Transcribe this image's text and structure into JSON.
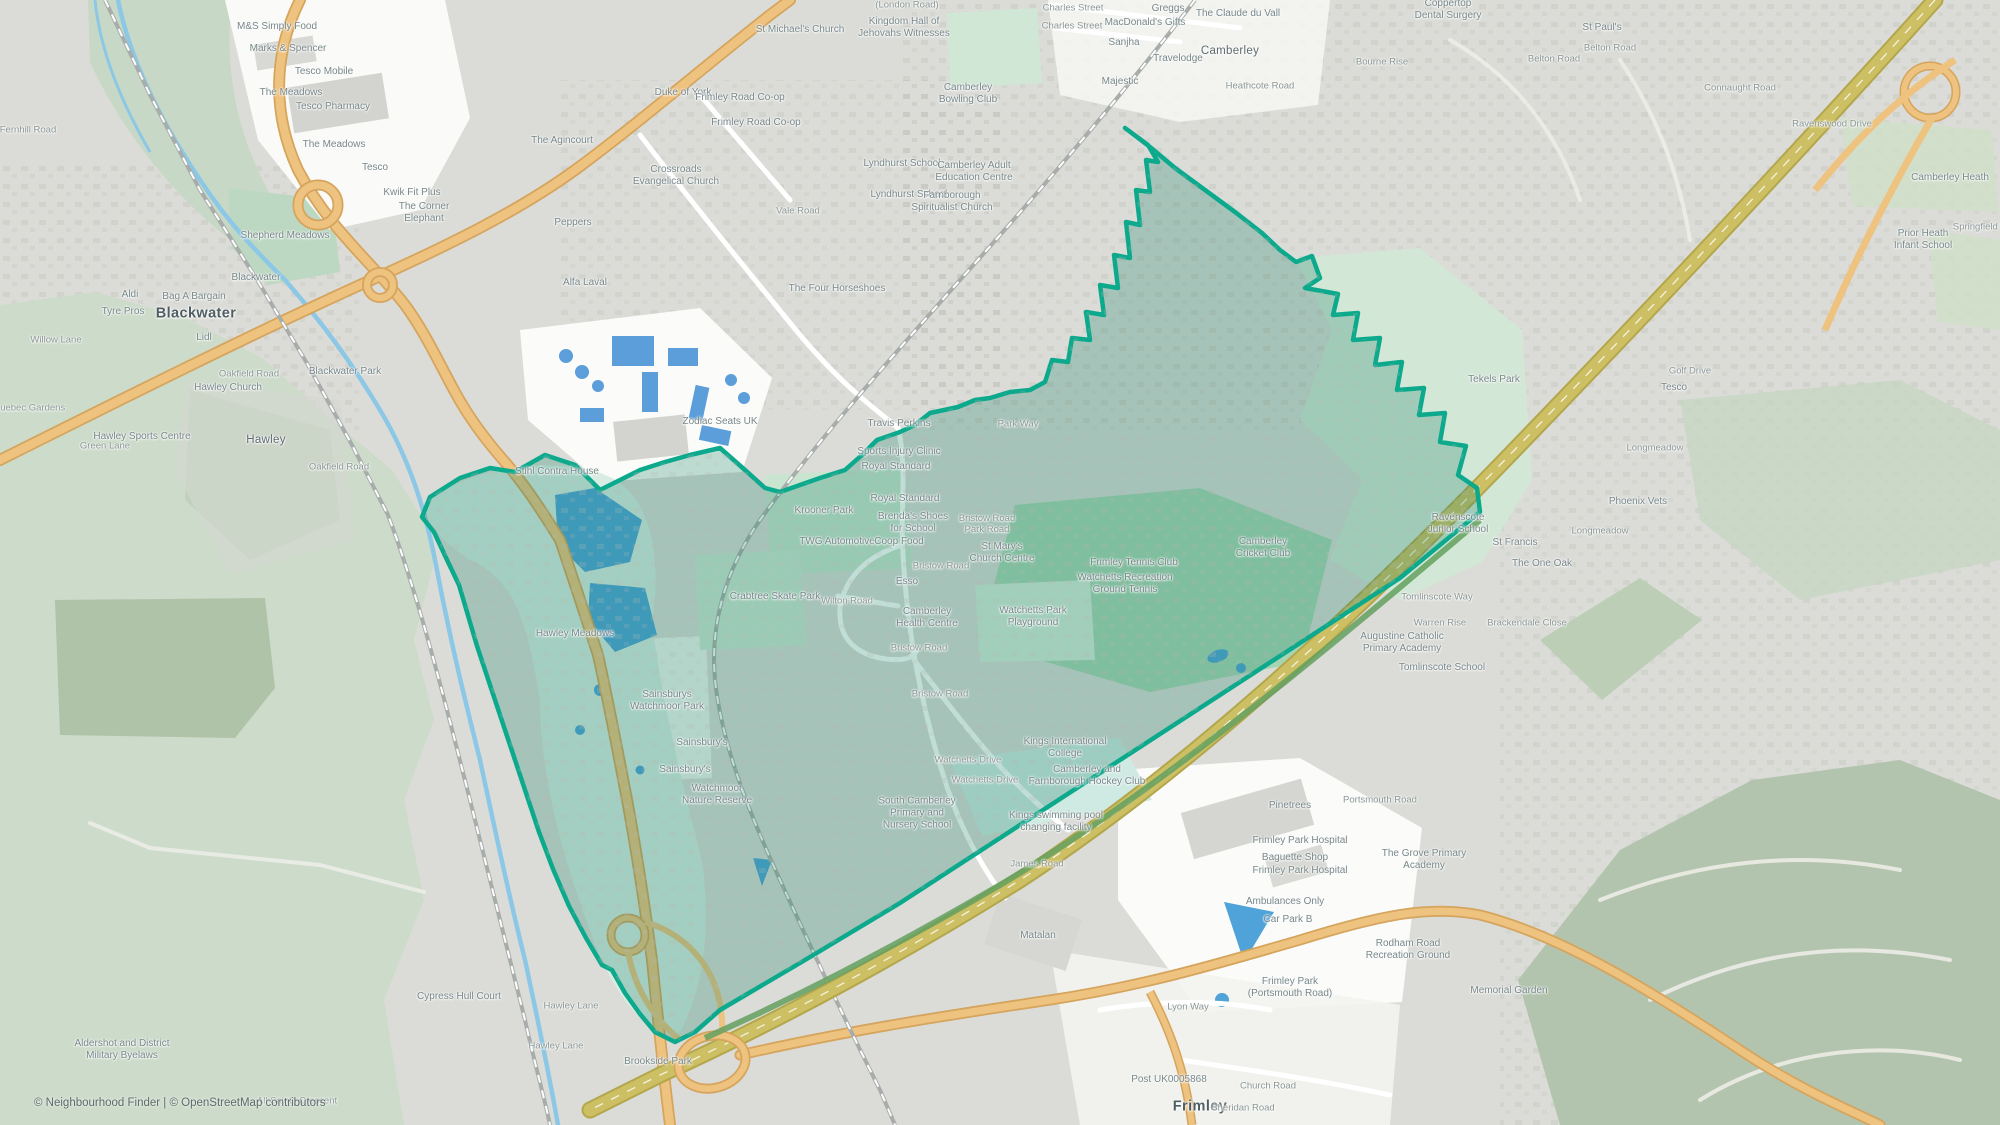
{
  "attribution": {
    "text": "© Neighbourhood Finder | © OpenStreetMap contributors"
  },
  "colors": {
    "urban": "#dbdcd7",
    "woodland": "#ccdbca",
    "park_mint": "#cde6d3",
    "recreation_green": "#a6d5b3",
    "retail_white": "#fafbf8",
    "water": "#4fa3d8",
    "river": "#8cc8e6",
    "road_primary_fill": "#eec27f",
    "road_primary_casing": "#d5a45d",
    "motorway_fill": "#cdbf63",
    "motorway_casing": "#b3a64b",
    "railway": "#a8adab",
    "building_blue": "#5b9ed9",
    "boundary_stroke": "#0ca98c",
    "boundary_fill": "rgba(23,128,104,0.27)",
    "boundary_green_strip": "#63a05f"
  },
  "labels": [
    {
      "lines": [
        "Blackwater"
      ],
      "x": 196,
      "y": 314,
      "k": "city"
    },
    {
      "lines": [
        "Frimley"
      ],
      "x": 1200,
      "y": 1107,
      "k": "city"
    },
    {
      "lines": [
        "Hawley"
      ],
      "x": 266,
      "y": 441,
      "k": "town"
    },
    {
      "lines": [
        "Camberley"
      ],
      "x": 1230,
      "y": 52,
      "k": "town"
    },
    {
      "lines": [
        "M&S Simply Food"
      ],
      "x": 277,
      "y": 27,
      "k": "poi"
    },
    {
      "lines": [
        "Marks & Spencer"
      ],
      "x": 288,
      "y": 49,
      "k": "poi"
    },
    {
      "lines": [
        "Tesco Mobile"
      ],
      "x": 324,
      "y": 72,
      "k": "poi"
    },
    {
      "lines": [
        "The Meadows"
      ],
      "x": 291,
      "y": 93,
      "k": "poi"
    },
    {
      "lines": [
        "Tesco Pharmacy"
      ],
      "x": 333,
      "y": 107,
      "k": "poi"
    },
    {
      "lines": [
        "The Meadows"
      ],
      "x": 334,
      "y": 145,
      "k": "poi"
    },
    {
      "lines": [
        "Tesco"
      ],
      "x": 375,
      "y": 168,
      "k": "poi"
    },
    {
      "lines": [
        "Kwik Fit Plus"
      ],
      "x": 412,
      "y": 193,
      "k": "poi"
    },
    {
      "lines": [
        "The Corner",
        "Elephant"
      ],
      "x": 424,
      "y": 213,
      "k": "poi"
    },
    {
      "lines": [
        "Shepherd Meadows"
      ],
      "x": 285,
      "y": 236,
      "k": "poi"
    },
    {
      "lines": [
        "Blackwater"
      ],
      "x": 256,
      "y": 278,
      "k": "poi"
    },
    {
      "lines": [
        "Aldi"
      ],
      "x": 130,
      "y": 295,
      "k": "poi"
    },
    {
      "lines": [
        "Bag A Bargain"
      ],
      "x": 194,
      "y": 297,
      "k": "poi"
    },
    {
      "lines": [
        "Tyre Pros"
      ],
      "x": 123,
      "y": 312,
      "k": "poi"
    },
    {
      "lines": [
        "Willow Lane"
      ],
      "x": 56,
      "y": 340,
      "k": "road"
    },
    {
      "lines": [
        "Lidl"
      ],
      "x": 204,
      "y": 338,
      "k": "poi"
    },
    {
      "lines": [
        "Oakfield Road"
      ],
      "x": 249,
      "y": 374,
      "k": "road"
    },
    {
      "lines": [
        "Blackwater Park"
      ],
      "x": 345,
      "y": 372,
      "k": "poi"
    },
    {
      "lines": [
        "Quebec Gardens"
      ],
      "x": 29,
      "y": 408,
      "k": "road"
    },
    {
      "lines": [
        "Green Lane"
      ],
      "x": 105,
      "y": 446,
      "k": "road"
    },
    {
      "lines": [
        "Fernhill Road"
      ],
      "x": 28,
      "y": 130,
      "k": "road"
    },
    {
      "lines": [
        "Hawley Church"
      ],
      "x": 228,
      "y": 388,
      "k": "poi"
    },
    {
      "lines": [
        "Hawley Sports Centre"
      ],
      "x": 142,
      "y": 437,
      "k": "poi"
    },
    {
      "lines": [
        "Oakfield Road"
      ],
      "x": 339,
      "y": 467,
      "k": "road"
    },
    {
      "lines": [
        "Hawley Meadows"
      ],
      "x": 575,
      "y": 634,
      "k": "poi"
    },
    {
      "lines": [
        "Stihl Contra House"
      ],
      "x": 557,
      "y": 472,
      "k": "poi"
    },
    {
      "lines": [
        "St Michael's Church"
      ],
      "x": 800,
      "y": 30,
      "k": "poi"
    },
    {
      "lines": [
        "(London Road)"
      ],
      "x": 907,
      "y": 5,
      "k": "road"
    },
    {
      "lines": [
        "Kingdom Hall of",
        "Jehovahs Witnesses"
      ],
      "x": 904,
      "y": 28,
      "k": "poi"
    },
    {
      "lines": [
        "Camberley",
        "Bowling Club"
      ],
      "x": 968,
      "y": 94,
      "k": "poi"
    },
    {
      "lines": [
        "Charles Street"
      ],
      "x": 1073,
      "y": 8,
      "k": "road"
    },
    {
      "lines": [
        "Charles Street"
      ],
      "x": 1072,
      "y": 26,
      "k": "road"
    },
    {
      "lines": [
        "Greggs"
      ],
      "x": 1168,
      "y": 9,
      "k": "poi"
    },
    {
      "lines": [
        "MacDonald's Gifts"
      ],
      "x": 1145,
      "y": 23,
      "k": "poi"
    },
    {
      "lines": [
        "The Claude du Vall"
      ],
      "x": 1238,
      "y": 14,
      "k": "poi"
    },
    {
      "lines": [
        "Sanjha"
      ],
      "x": 1124,
      "y": 43,
      "k": "poi"
    },
    {
      "lines": [
        "Travelodge"
      ],
      "x": 1178,
      "y": 59,
      "k": "poi"
    },
    {
      "lines": [
        "Majestic"
      ],
      "x": 1120,
      "y": 82,
      "k": "poi"
    },
    {
      "lines": [
        "Heathcote Road"
      ],
      "x": 1260,
      "y": 86,
      "k": "road"
    },
    {
      "lines": [
        "Duke of York"
      ],
      "x": 683,
      "y": 93,
      "k": "poi"
    },
    {
      "lines": [
        "Frimley Road Co-op"
      ],
      "x": 740,
      "y": 98,
      "k": "poi"
    },
    {
      "lines": [
        "Frimley Road Co-op"
      ],
      "x": 756,
      "y": 123,
      "k": "poi"
    },
    {
      "lines": [
        "The Agincourt"
      ],
      "x": 562,
      "y": 141,
      "k": "poi"
    },
    {
      "lines": [
        "Crossroads",
        "Evangelical Church"
      ],
      "x": 676,
      "y": 176,
      "k": "poi"
    },
    {
      "lines": [
        "Vale Road"
      ],
      "x": 798,
      "y": 211,
      "k": "road"
    },
    {
      "lines": [
        "Peppers"
      ],
      "x": 573,
      "y": 223,
      "k": "poi"
    },
    {
      "lines": [
        "Alfa Laval"
      ],
      "x": 585,
      "y": 283,
      "k": "poi"
    },
    {
      "lines": [
        "The Four Horseshoes"
      ],
      "x": 837,
      "y": 289,
      "k": "poi"
    },
    {
      "lines": [
        "Lyndhurst School"
      ],
      "x": 902,
      "y": 164,
      "k": "poi"
    },
    {
      "lines": [
        "Lyndhurst School"
      ],
      "x": 909,
      "y": 195,
      "k": "poi"
    },
    {
      "lines": [
        "Camberley Adult",
        "Education Centre"
      ],
      "x": 974,
      "y": 172,
      "k": "poi"
    },
    {
      "lines": [
        "Farnborough",
        "Spiritualist Church"
      ],
      "x": 952,
      "y": 202,
      "k": "poi"
    },
    {
      "lines": [
        "Coppertop",
        "Dental Surgery"
      ],
      "x": 1448,
      "y": 10,
      "k": "poi"
    },
    {
      "lines": [
        "St Paul's"
      ],
      "x": 1602,
      "y": 28,
      "k": "poi"
    },
    {
      "lines": [
        "Belton Road"
      ],
      "x": 1610,
      "y": 48,
      "k": "road"
    },
    {
      "lines": [
        "Belton Road"
      ],
      "x": 1554,
      "y": 59,
      "k": "road"
    },
    {
      "lines": [
        "Bourne Rise"
      ],
      "x": 1382,
      "y": 62,
      "k": "road"
    },
    {
      "lines": [
        "Connaught Road"
      ],
      "x": 1740,
      "y": 88,
      "k": "road"
    },
    {
      "lines": [
        "Ravenswood Drive"
      ],
      "x": 1832,
      "y": 124,
      "k": "road"
    },
    {
      "lines": [
        "Camberley Heath"
      ],
      "x": 1950,
      "y": 178,
      "k": "poi"
    },
    {
      "lines": [
        "Prior Heath",
        "Infant School"
      ],
      "x": 1923,
      "y": 240,
      "k": "poi"
    },
    {
      "lines": [
        "Springfield Road"
      ],
      "x": 1988,
      "y": 227,
      "k": "road"
    },
    {
      "lines": [
        "Golf Drive"
      ],
      "x": 1690,
      "y": 371,
      "k": "road"
    },
    {
      "lines": [
        "Tesco"
      ],
      "x": 1674,
      "y": 388,
      "k": "poi"
    },
    {
      "lines": [
        "Tekels Park"
      ],
      "x": 1494,
      "y": 380,
      "k": "poi"
    },
    {
      "lines": [
        "Longmeadow"
      ],
      "x": 1655,
      "y": 448,
      "k": "road"
    },
    {
      "lines": [
        "Longmeadow"
      ],
      "x": 1600,
      "y": 531,
      "k": "road"
    },
    {
      "lines": [
        "Phoenix Vets"
      ],
      "x": 1638,
      "y": 502,
      "k": "poi"
    },
    {
      "lines": [
        "The One Oak"
      ],
      "x": 1542,
      "y": 564,
      "k": "poi"
    },
    {
      "lines": [
        "Brackendale Close"
      ],
      "x": 1527,
      "y": 623,
      "k": "road"
    },
    {
      "lines": [
        "Ravenscote",
        "Junior School"
      ],
      "x": 1458,
      "y": 524,
      "k": "poi"
    },
    {
      "lines": [
        "St Francis"
      ],
      "x": 1515,
      "y": 543,
      "k": "poi"
    },
    {
      "lines": [
        "Tomlinscote Way"
      ],
      "x": 1437,
      "y": 597,
      "k": "road"
    },
    {
      "lines": [
        "Warren Rise"
      ],
      "x": 1440,
      "y": 623,
      "k": "road"
    },
    {
      "lines": [
        "Augustine Catholic",
        "Primary Academy"
      ],
      "x": 1402,
      "y": 643,
      "k": "poi"
    },
    {
      "lines": [
        "Tomlinscote School"
      ],
      "x": 1442,
      "y": 668,
      "k": "poi"
    },
    {
      "lines": [
        "Park Way"
      ],
      "x": 1018,
      "y": 424,
      "k": "road"
    },
    {
      "lines": [
        "Zodiac Seats UK"
      ],
      "x": 720,
      "y": 422,
      "k": "poi"
    },
    {
      "lines": [
        "Travis Perkins"
      ],
      "x": 899,
      "y": 424,
      "k": "poi"
    },
    {
      "lines": [
        "Sports Injury Clinic"
      ],
      "x": 899,
      "y": 452,
      "k": "poi"
    },
    {
      "lines": [
        "Royal Standard"
      ],
      "x": 896,
      "y": 467,
      "k": "poi"
    },
    {
      "lines": [
        "Royal Standard"
      ],
      "x": 905,
      "y": 499,
      "k": "poi"
    },
    {
      "lines": [
        "Krooner Park"
      ],
      "x": 824,
      "y": 511,
      "k": "poi"
    },
    {
      "lines": [
        "Brenda's Shoes",
        "for School"
      ],
      "x": 913,
      "y": 523,
      "k": "poi"
    },
    {
      "lines": [
        "TWG Automotive"
      ],
      "x": 837,
      "y": 542,
      "k": "poi"
    },
    {
      "lines": [
        "Coop Food"
      ],
      "x": 899,
      "y": 542,
      "k": "poi"
    },
    {
      "lines": [
        "Bristow Road"
      ],
      "x": 941,
      "y": 566,
      "k": "road"
    },
    {
      "lines": [
        "Esso"
      ],
      "x": 907,
      "y": 582,
      "k": "poi"
    },
    {
      "lines": [
        "Crabtree Skate Park"
      ],
      "x": 775,
      "y": 597,
      "k": "poi"
    },
    {
      "lines": [
        "Wilton Road"
      ],
      "x": 847,
      "y": 601,
      "k": "road"
    },
    {
      "lines": [
        "Bristow Road",
        "Park Road"
      ],
      "x": 987,
      "y": 524,
      "k": "road"
    },
    {
      "lines": [
        "St Mary's",
        "Church Centre"
      ],
      "x": 1002,
      "y": 553,
      "k": "poi"
    },
    {
      "lines": [
        "Camberley",
        "Health Centre"
      ],
      "x": 927,
      "y": 618,
      "k": "poi"
    },
    {
      "lines": [
        "Bristow Road"
      ],
      "x": 919,
      "y": 648,
      "k": "road"
    },
    {
      "lines": [
        "Watchetts Park",
        "Playground"
      ],
      "x": 1033,
      "y": 617,
      "k": "poi"
    },
    {
      "lines": [
        "Frimley Tennis Club"
      ],
      "x": 1134,
      "y": 563,
      "k": "poi"
    },
    {
      "lines": [
        "Watchetts Recreation",
        "Ground Tennis"
      ],
      "x": 1125,
      "y": 584,
      "k": "poi"
    },
    {
      "lines": [
        "Camberley",
        "Cricket Club"
      ],
      "x": 1263,
      "y": 548,
      "k": "poi"
    },
    {
      "lines": [
        "Bristow Road"
      ],
      "x": 940,
      "y": 694,
      "k": "road"
    },
    {
      "lines": [
        "Sainsburys",
        "Watchmoor Park"
      ],
      "x": 667,
      "y": 701,
      "k": "poi"
    },
    {
      "lines": [
        "Sainsbury's"
      ],
      "x": 702,
      "y": 743,
      "k": "poi"
    },
    {
      "lines": [
        "Sainsbury's"
      ],
      "x": 685,
      "y": 770,
      "k": "poi"
    },
    {
      "lines": [
        "Watchmoor",
        "Nature Reserve"
      ],
      "x": 717,
      "y": 795,
      "k": "poi"
    },
    {
      "lines": [
        "Watchetts Drive"
      ],
      "x": 968,
      "y": 760,
      "k": "road"
    },
    {
      "lines": [
        "Watchetts Drive"
      ],
      "x": 985,
      "y": 780,
      "k": "road"
    },
    {
      "lines": [
        "South Camberley",
        "Primary and",
        "Nursery School"
      ],
      "x": 917,
      "y": 813,
      "k": "poi"
    },
    {
      "lines": [
        "Kings International",
        "College"
      ],
      "x": 1065,
      "y": 748,
      "k": "poi"
    },
    {
      "lines": [
        "Camberley and",
        "Farnborough Hockey Club"
      ],
      "x": 1087,
      "y": 776,
      "k": "poi"
    },
    {
      "lines": [
        "Kings swimming pool",
        "changing facility"
      ],
      "x": 1056,
      "y": 822,
      "k": "poi"
    },
    {
      "lines": [
        "James Road"
      ],
      "x": 1037,
      "y": 864,
      "k": "road"
    },
    {
      "lines": [
        "Matalan"
      ],
      "x": 1038,
      "y": 936,
      "k": "poi"
    },
    {
      "lines": [
        "Lyon Way"
      ],
      "x": 1188,
      "y": 1007,
      "k": "road"
    },
    {
      "lines": [
        "Pinetrees"
      ],
      "x": 1290,
      "y": 806,
      "k": "poi"
    },
    {
      "lines": [
        "Frimley Park Hospital"
      ],
      "x": 1300,
      "y": 841,
      "k": "poi"
    },
    {
      "lines": [
        "Baguette Shop"
      ],
      "x": 1295,
      "y": 858,
      "k": "poi"
    },
    {
      "lines": [
        "Frimley Park Hospital"
      ],
      "x": 1300,
      "y": 871,
      "k": "poi"
    },
    {
      "lines": [
        "Ambulances Only"
      ],
      "x": 1285,
      "y": 902,
      "k": "poi"
    },
    {
      "lines": [
        "Car Park B"
      ],
      "x": 1288,
      "y": 920,
      "k": "poi"
    },
    {
      "lines": [
        "Frimley Park",
        "(Portsmouth Road)"
      ],
      "x": 1290,
      "y": 988,
      "k": "poi"
    },
    {
      "lines": [
        "Portsmouth Road"
      ],
      "x": 1380,
      "y": 800,
      "k": "road"
    },
    {
      "lines": [
        "The Grove Primary",
        "Academy"
      ],
      "x": 1424,
      "y": 860,
      "k": "poi"
    },
    {
      "lines": [
        "Rodham Road",
        "Recreation Ground"
      ],
      "x": 1408,
      "y": 950,
      "k": "poi"
    },
    {
      "lines": [
        "Memorial Garden"
      ],
      "x": 1509,
      "y": 991,
      "k": "poi"
    },
    {
      "lines": [
        "Post UK0005868"
      ],
      "x": 1169,
      "y": 1080,
      "k": "poi"
    },
    {
      "lines": [
        "Church Road"
      ],
      "x": 1268,
      "y": 1086,
      "k": "road"
    },
    {
      "lines": [
        "Sheridan Road"
      ],
      "x": 1243,
      "y": 1108,
      "k": "road"
    },
    {
      "lines": [
        "All Saints Crescent"
      ],
      "x": 297,
      "y": 1101,
      "k": "road"
    },
    {
      "lines": [
        "Cypress Hull Court"
      ],
      "x": 459,
      "y": 997,
      "k": "poi"
    },
    {
      "lines": [
        "Hawley Lane"
      ],
      "x": 571,
      "y": 1006,
      "k": "road"
    },
    {
      "lines": [
        "Hawley Lane"
      ],
      "x": 556,
      "y": 1046,
      "k": "road"
    },
    {
      "lines": [
        "Brookside Park"
      ],
      "x": 658,
      "y": 1062,
      "k": "poi"
    },
    {
      "lines": [
        "Aldershot and District",
        "Military Byelaws"
      ],
      "x": 122,
      "y": 1050,
      "k": "poi"
    }
  ]
}
